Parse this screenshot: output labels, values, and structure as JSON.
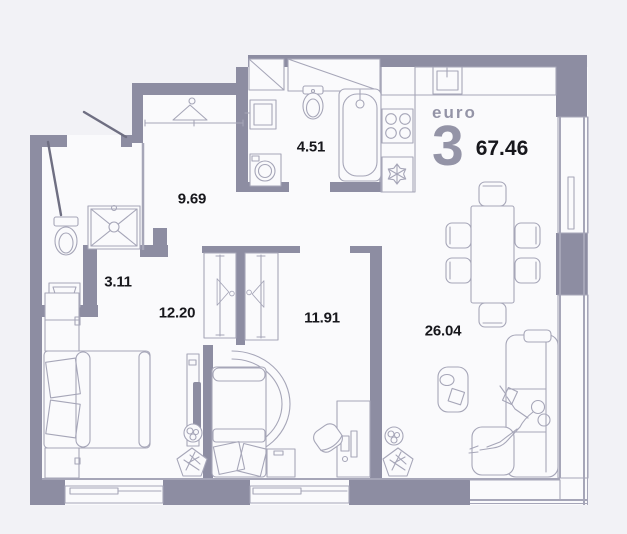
{
  "plan": {
    "title": {
      "type_label": "euro",
      "rooms_count": "3",
      "total_area": "67.46"
    },
    "rooms": [
      {
        "name": "hallway",
        "area": "9.69"
      },
      {
        "name": "bathroom",
        "area": "4.51"
      },
      {
        "name": "wc-shower-room",
        "area": "3.11"
      },
      {
        "name": "bedroom",
        "area": "12.20"
      },
      {
        "name": "bedroom-2",
        "area": "11.91"
      },
      {
        "name": "kitchen-living-room",
        "area": "26.04"
      }
    ],
    "colors": {
      "wall": "#8d8da2",
      "line": "#a6a6b8",
      "line_dark": "#6f6f82",
      "floor": "#fafafc",
      "background": "#f2f2f6",
      "text": "#17171c",
      "muted": "#9494a7"
    }
  }
}
